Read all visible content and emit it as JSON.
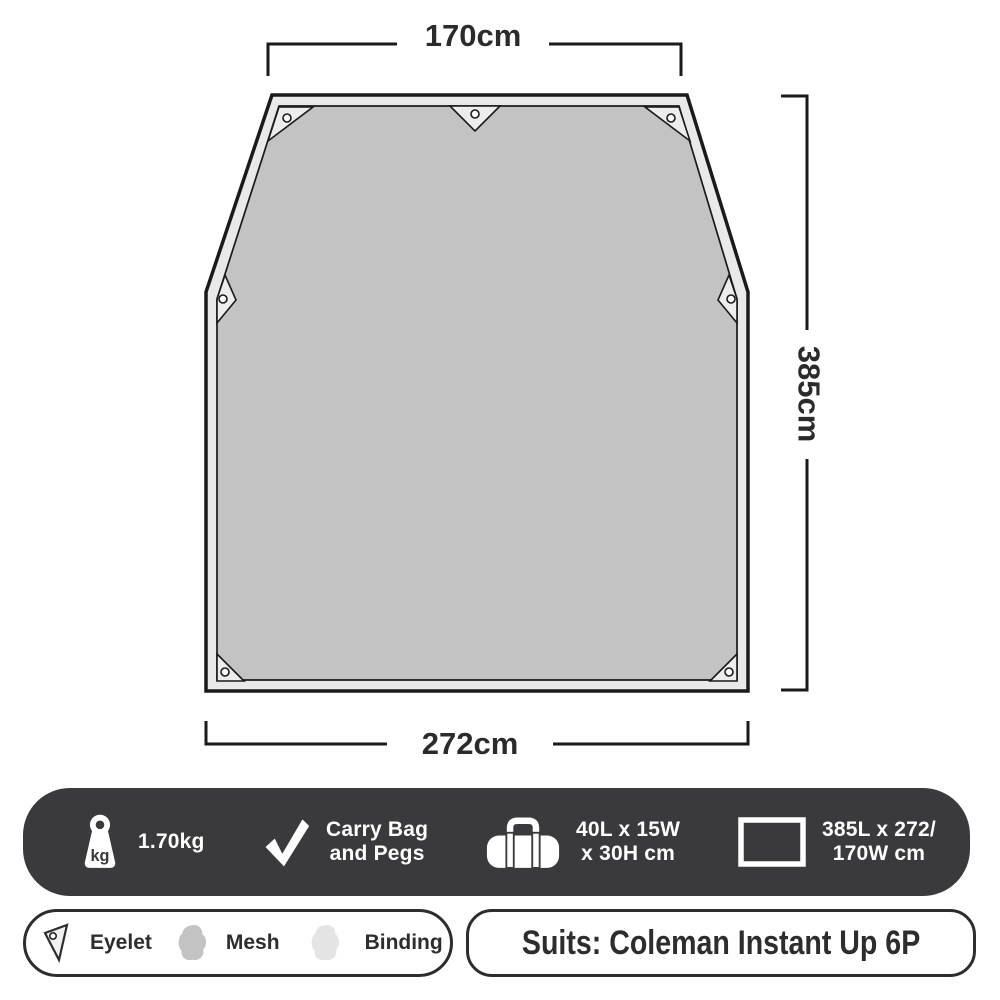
{
  "diagram": {
    "top_dimension": "170cm",
    "side_dimension": "385cm",
    "bottom_dimension": "272cm"
  },
  "spec_bar": {
    "weight": {
      "icon": "weight-kg-icon",
      "unit_glyph": "kg",
      "label": "1.70kg"
    },
    "included": {
      "icon": "check-icon",
      "line1": "Carry Bag",
      "line2": "and Pegs"
    },
    "packed": {
      "icon": "duffel-bag-icon",
      "line1": "40L x 15W",
      "line2": "x 30H cm"
    },
    "flat_size": {
      "icon": "rectangle-outline-icon",
      "line1": "385L x 272/",
      "line2": "170W cm"
    }
  },
  "legend": {
    "eyelet": {
      "icon": "eyelet-triangle-icon",
      "label": "Eyelet"
    },
    "mesh": {
      "icon": "mesh-swatch-icon",
      "label": "Mesh"
    },
    "binding": {
      "icon": "binding-swatch-icon",
      "label": "Binding"
    }
  },
  "suits": {
    "label": "Suits: Coleman Instant Up 6P"
  },
  "colors": {
    "spec_bar_bg": "#3a393b",
    "tarp_fill": "#c3c3c3",
    "tarp_binding": "#e9e9e9",
    "eyelet_patch": "#ededed",
    "outline": "#1a1a1a",
    "text_dark": "#2d2d2f",
    "text_light": "#ffffff"
  }
}
